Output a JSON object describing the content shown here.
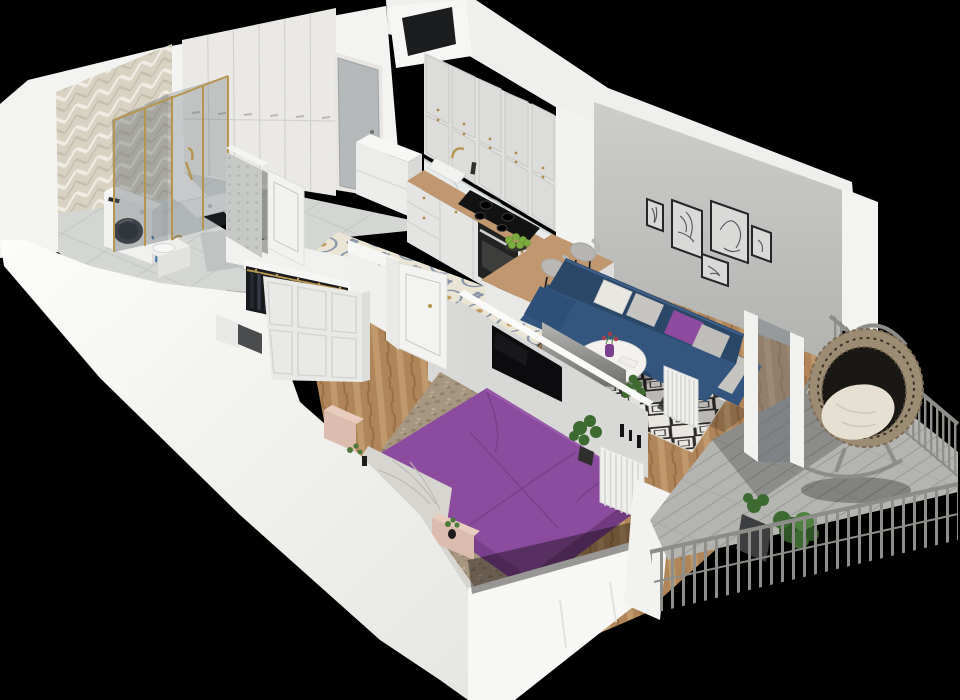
{
  "scene": {
    "title": "3D isometric cutaway floor plan render of a one-bedroom apartment on a black background",
    "type": "architectural 3d floor plan visualization",
    "rooms": [
      {
        "name": "bathroom",
        "position": "top-left",
        "items": [
          "herringbone tiled accent wall",
          "glass shower enclosure with gold trim",
          "white shower tray",
          "washing machine with dark round door",
          "white vanity counter with gold faucet",
          "grey tile floor with darker inset mat",
          "mosaic partition wall",
          "open white door"
        ]
      },
      {
        "name": "hallway",
        "position": "top-center",
        "items": [
          "floor-to-ceiling white wardrobe with six panels",
          "grey entrance door",
          "white refrigerator",
          "large grey floor tiles",
          "wall niche shaft"
        ]
      },
      {
        "name": "kitchen",
        "position": "top-center-right",
        "items": [
          "two rows of white framed upper cabinets with gold knobs",
          "marble backsplash",
          "wood countertop with peninsula bar",
          "white base cabinets",
          "sink with gold faucet",
          "black cooktop",
          "built-in black oven",
          "plate of green apples",
          "two grey upholstered bar stools",
          "ornamental cream-and-blue tile floor"
        ]
      },
      {
        "name": "living-room",
        "position": "right",
        "items": [
          "grey concrete feature wall",
          "five black-framed line-art prints",
          "navy blue sofa",
          "white, grey and purple cushions",
          "black-and-white diamond rug",
          "round white coffee table",
          "purple vase with red flowers",
          "grey TV panel",
          "potted plants",
          "white slatted radiator",
          "glass balcony door",
          "herringbone wood floor"
        ]
      },
      {
        "name": "bedroom",
        "position": "bottom-center",
        "items": [
          "double bed with purple duvet",
          "draped grey-white blanket",
          "blush pink bed frame and benches",
          "speckled beige rug",
          "open clothes rack with dark hanging garments",
          "white framed closet",
          "grey storage box",
          "wall-mounted black TV on partition",
          "open white door",
          "white slatted radiator",
          "black decorative vases",
          "potted plant",
          "herringbone wood floor"
        ]
      },
      {
        "name": "balcony",
        "position": "bottom-right",
        "items": [
          "round rattan egg chair with cream cushion",
          "grey metal mesh railing",
          "grey vertical-bar railing",
          "concrete plank floor",
          "green potted plants",
          "dark planter box"
        ]
      }
    ]
  },
  "palette": {
    "background": "#000000",
    "wall_white": "#f3f3f1",
    "wall_top_white": "#fafaf8",
    "living_wall_grey": "#c6c6c4",
    "partition_grey": "#d8d8d6",
    "door_grey": "#b6b9ba",
    "wardrobe_white": "#eae9e6",
    "cabinet_white": "#e1e1df",
    "countertop_wood": "#c0976f",
    "cooktop_black": "#121212",
    "oven_black": "#222222",
    "sofa_blue": "#33557e",
    "sofa_blue_dark": "#2a4768",
    "pillow_white": "#e9e7e2",
    "pillow_grey": "#c7c5c1",
    "pillow_purple": "#8d4a9e",
    "bed_purple": "#8b4b9e",
    "bed_purple_dark": "#713a80",
    "blanket_grey": "#d7d5d0",
    "frame_pink": "#dcbcae",
    "rug_beige": "#a79781",
    "clothes_dark": "#17191d",
    "tv_black": "#0c0c0e",
    "vase_purple": "#7b3f90",
    "gold": "#b5954f",
    "wood_floor": "#b0855a",
    "tile_cream": "#eae4d4",
    "tile_blue": "#8795a9",
    "tile_grey": "#d3d6d3",
    "radiator_white": "#f0f1ef",
    "balcony_floor": "#b4b4b1",
    "railing_grey": "#8f8f8b",
    "rattan": "#9c8c74",
    "cushion_cream": "#e6e0d2",
    "plant_green": "#4c7a3a",
    "plant_green_dark": "#2f5527",
    "shadow": "rgba(0,0,0,0.25)"
  }
}
